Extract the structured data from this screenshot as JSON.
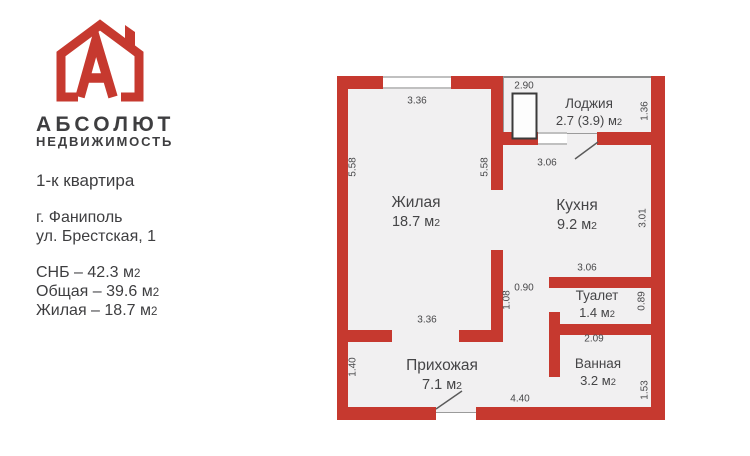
{
  "colors": {
    "red": "#c6392f",
    "floor": "#f1f0f1",
    "line": "#9b9b9b",
    "text": "#3e3e40"
  },
  "logo": {
    "brand": "АБСОЛЮТ",
    "tagline": "НЕДВИЖИМОСТЬ",
    "letter": "А"
  },
  "listing": {
    "type": "1-к квартира",
    "city": "г. Фаниполь",
    "address": "ул. Брестская, 1",
    "metrics": [
      {
        "text": "СНБ – 42.3"
      },
      {
        "text": "Общая –  39.6"
      },
      {
        "text": "Жилая – 18.7"
      }
    ]
  },
  "units": {
    "m": "м",
    "sub": "2"
  },
  "plan": {
    "rooms": {
      "living": {
        "name": "Жилая",
        "area": "18.7"
      },
      "kitchen": {
        "name": "Кухня",
        "area": "9.2"
      },
      "loggia": {
        "name": "Лоджия",
        "area": "2.7 (3.9)"
      },
      "toilet": {
        "name": "Туалет",
        "area": "1.4"
      },
      "bath": {
        "name": "Ванная",
        "area": "3.2"
      },
      "hall": {
        "name": "Прихожая",
        "area": "7.1"
      }
    },
    "dims": {
      "living_top": "3.36",
      "living_left": "5.58",
      "living_right": "5.58",
      "loggia_top": "2.90",
      "loggia_right": "1.36",
      "loggia_bottom": "3.06",
      "kitchen_right": "3.01",
      "kitchen_bottom": "3.06",
      "passage_width": "0.90",
      "passage_height": "1.08",
      "toilet_right": "0.89",
      "bath_top": "2.09",
      "bath_right": "1.53",
      "hall_top": "3.36",
      "hall_left": "1.40",
      "hall_bottom": "4.40"
    }
  }
}
